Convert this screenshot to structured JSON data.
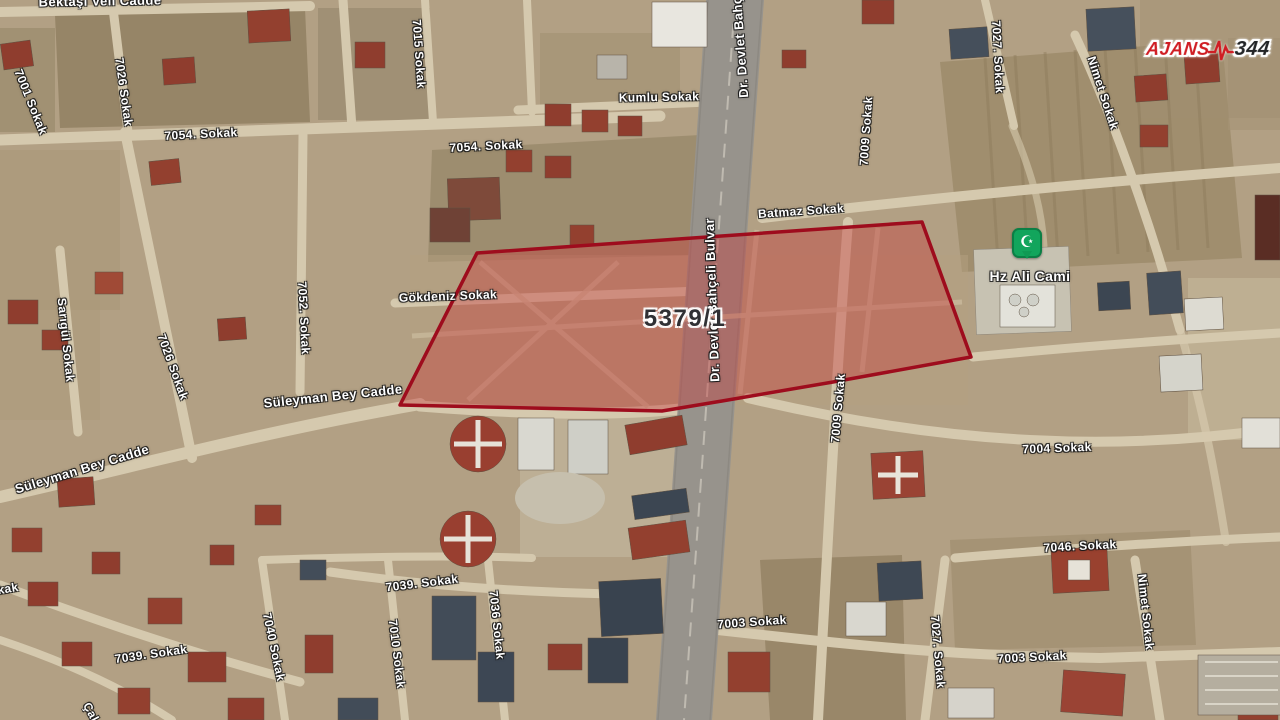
{
  "map": {
    "parcel": {
      "label": "5379/1",
      "label_x": 685,
      "label_y": 319,
      "points": "477,253 922,222 971,357 833,382 722,401 662,411 400,405",
      "fill": "rgba(197,60,60,0.42)",
      "stroke": "#9e0c1d",
      "stroke_width": 3.5
    },
    "poi": {
      "name": "Hz Ali Cami",
      "icon": "mosque-crescent-icon",
      "glyph": "☪",
      "pin_x": 1027,
      "pin_y": 258,
      "label_x": 1030,
      "label_y": 276,
      "pin_color": "#12a55c"
    },
    "logo": {
      "part1": "AJANS",
      "part2": "344",
      "x": 1208,
      "y": 49,
      "accent": "#cf1d23"
    },
    "labels": [
      {
        "t": "Bektaşı Veli Cadde",
        "x": 100,
        "y": 1,
        "r": -1,
        "s": 13
      },
      {
        "t": "7001 Sokak",
        "x": 31,
        "y": 102,
        "r": 68,
        "s": 12
      },
      {
        "t": "7026 Sokak",
        "x": 124,
        "y": 92,
        "r": 82,
        "s": 12
      },
      {
        "t": "7054. Sokak",
        "x": 201,
        "y": 134,
        "r": -3,
        "s": 12
      },
      {
        "t": "7015 Sokak",
        "x": 419,
        "y": 54,
        "r": 86,
        "s": 12
      },
      {
        "t": "7054. Sokak",
        "x": 486,
        "y": 146,
        "r": -3,
        "s": 12
      },
      {
        "t": "Kumlu Sokak",
        "x": 659,
        "y": 97,
        "r": -1,
        "s": 12
      },
      {
        "t": "Dr. Devlet Bahçeli Bulvar",
        "x": 738,
        "y": 16,
        "r": -94,
        "s": 13
      },
      {
        "t": "Batmaz Sokak",
        "x": 801,
        "y": 211,
        "r": -4,
        "s": 12
      },
      {
        "t": "7009 Sokak",
        "x": 866,
        "y": 131,
        "r": -86,
        "s": 12
      },
      {
        "t": "7027. Sokak",
        "x": 998,
        "y": 57,
        "r": 87,
        "s": 12
      },
      {
        "t": "Nimet Sokak",
        "x": 1103,
        "y": 93,
        "r": 72,
        "s": 12
      },
      {
        "t": "Gökdeniz Sokak",
        "x": 448,
        "y": 296,
        "r": -2,
        "s": 12
      },
      {
        "t": "Dr. Devlet Bahçeli Bulvar",
        "x": 712,
        "y": 300,
        "r": -92,
        "s": 13
      },
      {
        "t": "Sarıgül Sokak",
        "x": 66,
        "y": 340,
        "r": 84,
        "s": 12
      },
      {
        "t": "7052. Sokak",
        "x": 304,
        "y": 318,
        "r": 87,
        "s": 12
      },
      {
        "t": "7026 Sokak",
        "x": 173,
        "y": 367,
        "r": 70,
        "s": 12
      },
      {
        "t": "Süleyman Bey Cadde",
        "x": 82,
        "y": 469,
        "r": -17,
        "s": 13
      },
      {
        "t": "Süleyman Bey Cadde",
        "x": 333,
        "y": 396,
        "r": -6,
        "s": 13
      },
      {
        "t": "7009 Sokak",
        "x": 838,
        "y": 408,
        "r": -85,
        "s": 12
      },
      {
        "t": "7004 Sokak",
        "x": 1057,
        "y": 448,
        "r": -2,
        "s": 12
      },
      {
        "t": "7046. Sokak",
        "x": 1080,
        "y": 546,
        "r": -3,
        "s": 12
      },
      {
        "t": "Nimet Sokak",
        "x": 1146,
        "y": 612,
        "r": 84,
        "s": 12
      },
      {
        "t": "7039. Sokak",
        "x": 151,
        "y": 654,
        "r": -8,
        "s": 12
      },
      {
        "t": "7040 Sokak",
        "x": 274,
        "y": 647,
        "r": 78,
        "s": 12
      },
      {
        "t": "7039. Sokak",
        "x": 422,
        "y": 583,
        "r": -7,
        "s": 12
      },
      {
        "t": "7010 Sokak",
        "x": 397,
        "y": 654,
        "r": 83,
        "s": 12
      },
      {
        "t": "7036 Sokak",
        "x": 497,
        "y": 625,
        "r": 84,
        "s": 12
      },
      {
        "t": "7003 Sokak",
        "x": 752,
        "y": 622,
        "r": -4,
        "s": 12
      },
      {
        "t": "7027. Sokak",
        "x": 938,
        "y": 652,
        "r": 85,
        "s": 12
      },
      {
        "t": "7003 Sokak",
        "x": 1032,
        "y": 657,
        "r": -3,
        "s": 12
      },
      {
        "t": "Sokak",
        "x": 0,
        "y": 590,
        "r": -10,
        "s": 12
      },
      {
        "t": "Çal",
        "x": 91,
        "y": 712,
        "r": 62,
        "s": 12
      }
    ]
  }
}
